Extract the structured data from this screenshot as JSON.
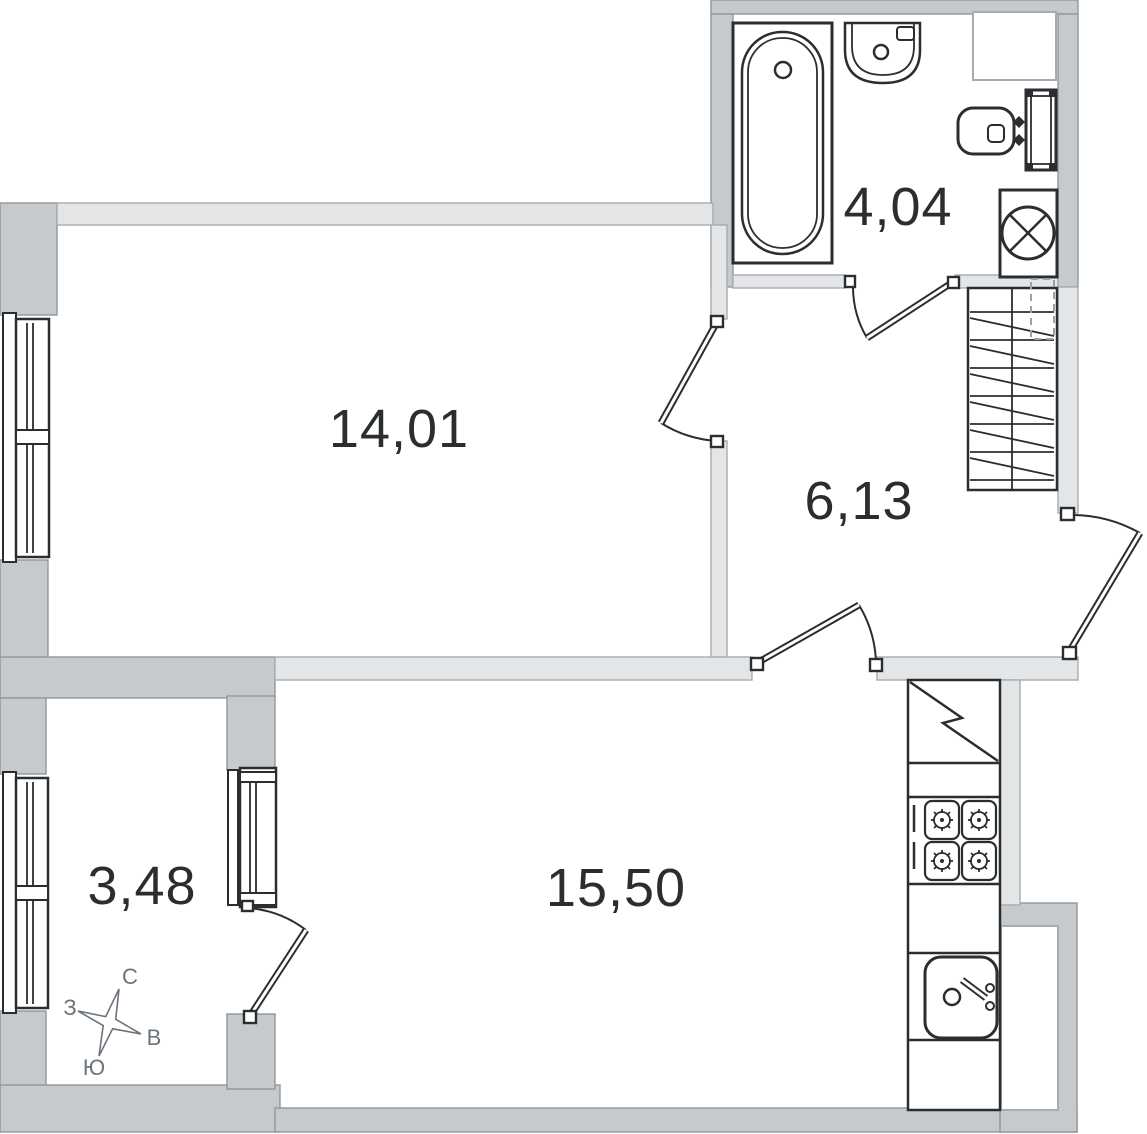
{
  "plan": {
    "title": "apartment-floor-plan",
    "rooms": [
      {
        "name": "room",
        "area": "14,01"
      },
      {
        "name": "bathroom",
        "area": "4,04"
      },
      {
        "name": "hallway",
        "area": "6,13"
      },
      {
        "name": "kitchen-living",
        "area": "15,50"
      },
      {
        "name": "balcony",
        "area": "3,48"
      }
    ],
    "compass": {
      "north": "С",
      "east": "В",
      "south": "Ю",
      "west": "З"
    },
    "colors": {
      "wall_exterior": "#c7cacc",
      "wall_interior": "#e3e5e7",
      "line": "#2b2e31",
      "label": "#2b2e31",
      "compass": "#6b747d"
    }
  }
}
